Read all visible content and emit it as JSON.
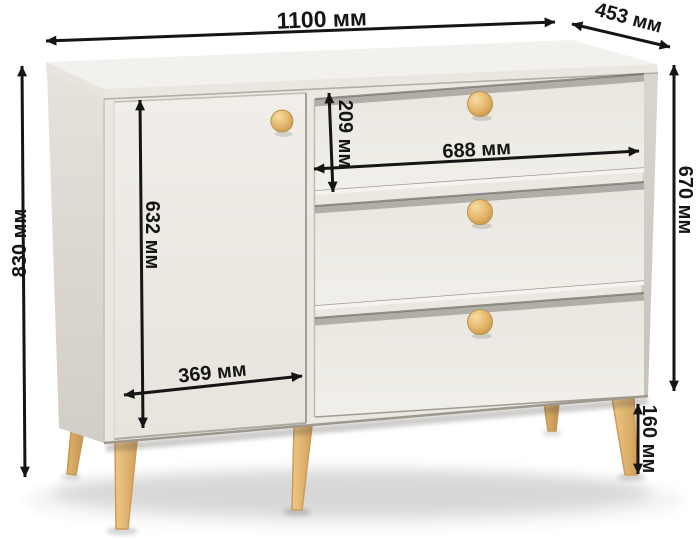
{
  "diagram": {
    "subject": "chest-of-drawers",
    "unit": "мм",
    "doors_visible": 1,
    "drawers_visible": 3,
    "knobs_visible": 4,
    "legs_visible": 5
  },
  "dimensions": {
    "overall_width": {
      "value": 1100,
      "unit": "мм",
      "label": "1100 мм"
    },
    "depth": {
      "value": 453,
      "unit": "мм",
      "label": "453 мм"
    },
    "overall_height": {
      "value": 830,
      "unit": "мм",
      "label": "830 мм"
    },
    "body_height": {
      "value": 670,
      "unit": "мм",
      "label": "670 мм"
    },
    "door_height": {
      "value": 632,
      "unit": "мм",
      "label": "632 мм"
    },
    "door_width": {
      "value": 369,
      "unit": "мм",
      "label": "369 мм"
    },
    "top_drawer_height": {
      "value": 209,
      "unit": "мм",
      "label": "209 мм"
    },
    "drawer_width": {
      "value": 688,
      "unit": "мм",
      "label": "688 мм"
    },
    "leg_height": {
      "value": 160,
      "unit": "мм",
      "label": "160 мм"
    }
  },
  "colors": {
    "background": "#ffffff",
    "dimension_ink": "#151515",
    "body_front": "#ebe8e2",
    "body_side": "#dcd8d1",
    "top_surface": "#f3f1ee",
    "knob_wood": "#e3b368",
    "leg_wood": "#e2b370"
  }
}
